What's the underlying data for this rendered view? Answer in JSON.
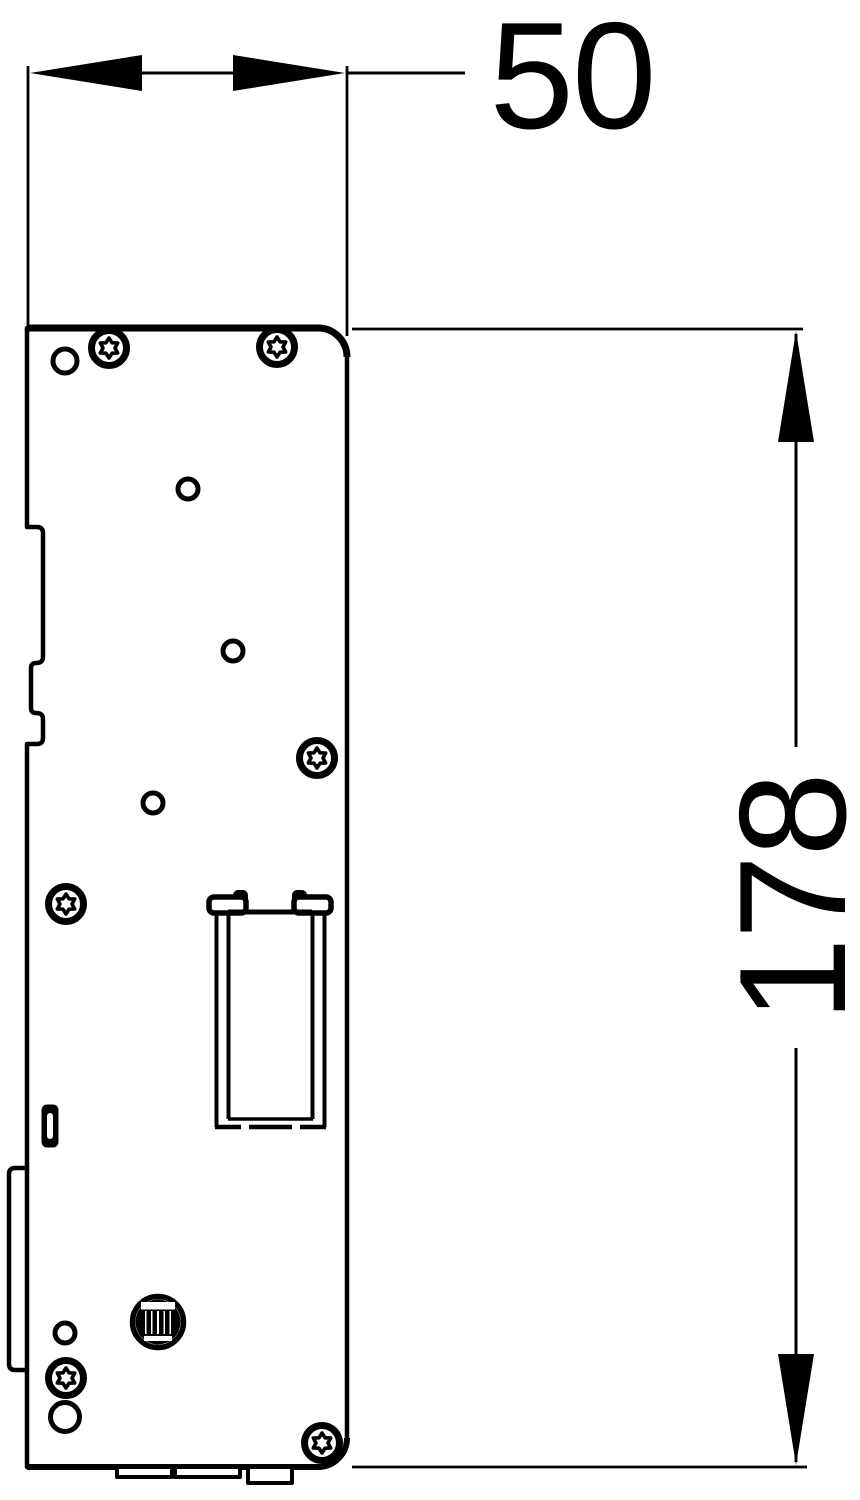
{
  "drawing": {
    "description": "Technical side-view line drawing of a DIN-rail mounted device with overall outer dimensions",
    "colors": {
      "line": "#000000",
      "background": "#ffffff"
    },
    "dimensions": {
      "width": {
        "label": "50"
      },
      "height": {
        "label": "178"
      }
    }
  }
}
